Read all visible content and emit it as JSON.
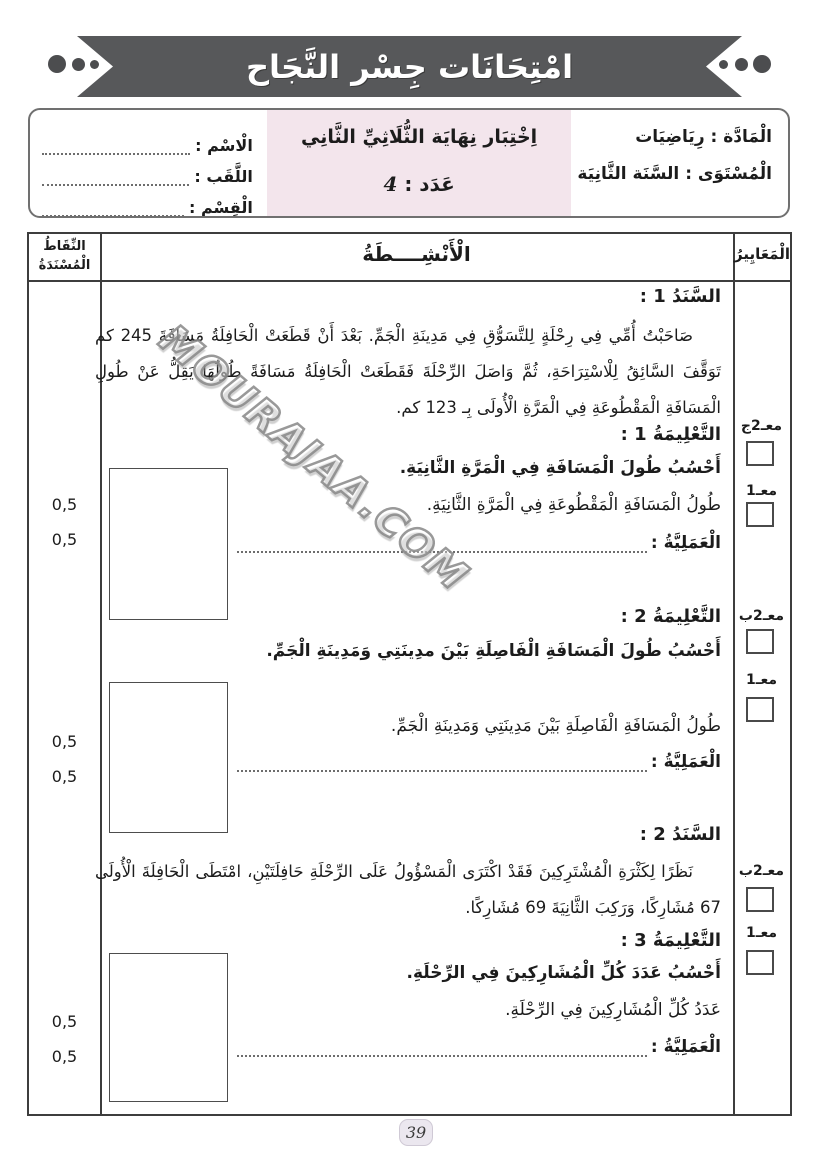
{
  "colors": {
    "ribbon": "#57585a",
    "exam_panel_pink": "#f3e5ec",
    "table_border": "#3d3d3d",
    "page_badge_bg": "#ebe7ef"
  },
  "banner": {
    "title": "امْتِحَانَات جِسْر النَّجَاح"
  },
  "header": {
    "subject": {
      "label": "الْمَادَّة :",
      "value": "رِيَاضِيَات"
    },
    "level": {
      "label": "الْمُسْتَوَى :",
      "value": "السَّنَة الثَّانِيَة"
    },
    "exam": {
      "title": "اِخْتِبَار نِهَايَة الثُّلَاثِيِّ الثَّانِي",
      "number_label": "عَدَد :",
      "number_value": "4"
    },
    "student": {
      "name_label": "الْاسْم :",
      "name_value": "",
      "surname_label": "اللَّقَب :",
      "surname_value": "",
      "class_label": "الْقِسْم :",
      "class_value": ""
    }
  },
  "table": {
    "headers": {
      "points_line1": "النِّقَاطُ",
      "points_line2": "الْمُسْنَدَةُ",
      "activities": "الْأَنْشِــــطَةُ",
      "criteria": "الْمَعَايِيرُ"
    }
  },
  "content": {
    "sanad1": {
      "heading": "السَّنَدُ 1 :",
      "text": "صَاحَبْتُ أُمِّي فِي رِحْلَةٍ لِلتَّسَوُّقِ فِي مَدِينَةِ الْجَمِّ. بَعْدَ أَنْ قَطَعَتْ الْحَافِلَةُ مَسَافَةَ 245 كم تَوَقَّفَ السَّائِقُ لِلْاسْتِرَاحَةِ، ثُمَّ وَاصَلَ الرِّحْلَةَ فَقَطَعَتْ الْحَافِلَةُ مَسَافَةً طُولُهَا يَقِلُّ عَنْ طُولِ الْمَسَافَةِ الْمَقْطُوعَةِ فِي الْمَرَّةِ الْأُولَى بِـ 123 كم."
    },
    "instr1": {
      "heading": "التَّعْلِيمَةُ 1 :",
      "task": "أَحْسُبُ طُولَ الْمَسَافَةِ فِي الْمَرَّةِ الثَّانِيَةِ.",
      "answer": "طُولُ الْمَسَافَةِ الْمَقْطُوعَةِ فِي الْمَرَّةِ الثَّانِيَةِ.",
      "operation_label": "الْعَمَلِيَّةُ :"
    },
    "instr2": {
      "heading": "التَّعْلِيمَةُ 2 :",
      "task": "أَحْسُبُ طُولَ الْمَسَافَةِ الْفَاصِلَةِ بَيْنَ مدِينَتِي وَمَدِينَةِ الْجَمِّ.",
      "answer": "طُولُ الْمَسَافَةِ الْفَاصِلَةِ بَيْنَ مَدِينَتِي وَمَدِينَةِ الْجَمِّ.",
      "operation_label": "الْعَمَلِيَّةُ :"
    },
    "sanad2": {
      "heading": "السَّنَدُ 2 :",
      "text": "نَظَرًا لِكَثْرَةِ الْمُشْتَرِكِينَ فَقَدْ اكْتَرَى الْمَسْؤُولُ عَلَى الرِّحْلَةِ حَافِلَتَيْنِ، امْتَطَى الْحَافِلَةَ الْأُولَى 67 مُشَارِكًا، وَرَكِبَ الثَّانِيَةَ 69 مُشَارِكًا."
    },
    "instr3": {
      "heading": "التَّعْلِيمَةُ 3 :",
      "task": "أَحْسُبُ عَدَدَ كُلِّ الْمُشَارِكِينَ فِي الرِّحْلَةِ.",
      "answer": "عَدَدُ كُلِّ الْمُشَارِكِينَ فِي الرِّحْلَةِ.",
      "operation_label": "الْعَمَلِيَّةُ :"
    }
  },
  "criteria": {
    "groups": [
      {
        "first": "معـ2ج",
        "second": "معـ1"
      },
      {
        "first": "معـ2ب",
        "second": "معـ1"
      },
      {
        "first": "معـ2ب",
        "second": "معـ1"
      }
    ]
  },
  "points": [
    "0,5",
    "0,5",
    "0,5",
    "0,5",
    "0,5",
    "0,5"
  ],
  "watermark": "MOURAJAA.COM",
  "page_number": "39"
}
